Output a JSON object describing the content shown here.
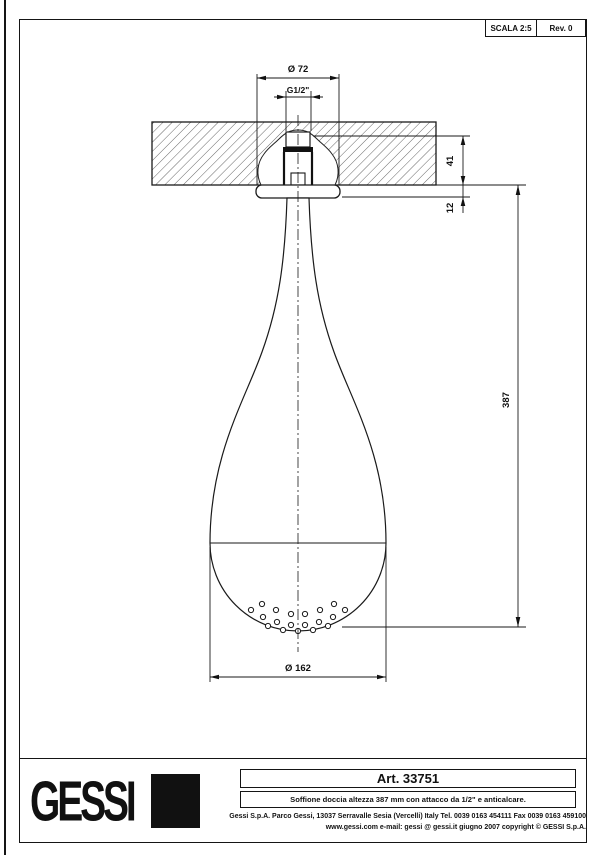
{
  "title_block": {
    "scale_label": "SCALA 2:5",
    "rev_label": "Rev. 0",
    "logo_text": "GESSI",
    "art_label": "Art. 33751",
    "description": "Soffione doccia altezza 387 mm con attacco da 1/2\" e anticalcare.",
    "footer_line1": "Gessi S.p.A. Parco Gessi, 13037 Serravalle Sesia (Vercelli) Italy Tel. 0039 0163 454111 Fax 0039 0163 459100",
    "footer_line2": "www.gessi.com e-mail: gessi @ gessi.it giugno 2007 copyright © GESSI S.p.A."
  },
  "dimensions": {
    "top_diameter": "Ø 72",
    "thread": "G1/2\"",
    "embed_depth": "41",
    "flange_height": "12",
    "total_height": "387",
    "head_diameter": "Ø 162"
  },
  "drawing": {
    "line_color": "#1a1a1a",
    "hatch_color": "#555555"
  }
}
